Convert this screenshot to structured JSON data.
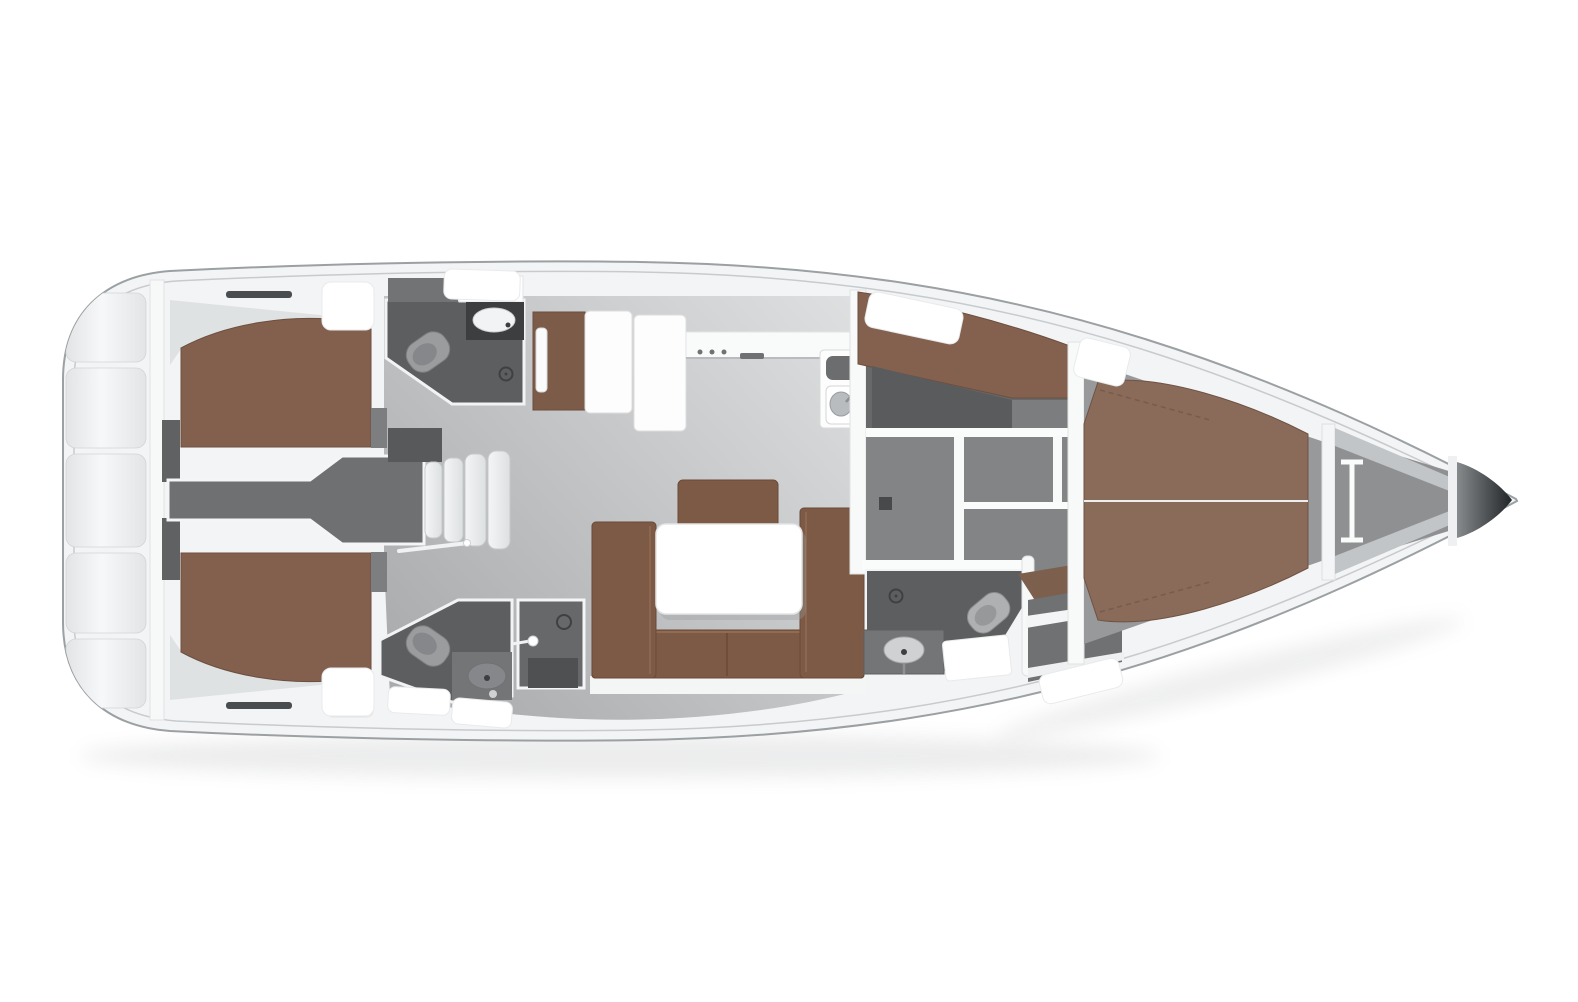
{
  "colors": {
    "background": "#ffffff",
    "hull_fill": "#f3f4f5",
    "hull_outline": "#9ba0a3",
    "inner_gunwale": "#c7cbcd",
    "platform_light": "#f7f8f9",
    "platform_dark": "#e2e4e6",
    "platform_seam": "#d2d5d7",
    "transom_wall": "#f7f8f8",
    "vent_slat": "#4a4d4f",
    "dark_strip": "#5f6163",
    "corner_shade": "#ccd0d2",
    "berth_aft": "#83604d",
    "berth_edge": "#6d4f3f",
    "berth_side": "#84614e",
    "berth_fwd": "#8a6a58",
    "berth_wedge": "#7d5f4e",
    "berth_seam": "#eceded",
    "quilt_line": "#6d5142",
    "cabin_locker": "#fefefe",
    "locker_stroke": "#e1e3e5",
    "head_floor": "#5c5e5f",
    "head_shelf": "#717375",
    "head_counter": "#3c3e3f",
    "shower_stall": "#66686a",
    "shower_tray": "#4e5052",
    "fixture_light": "#9a9c9e",
    "fixture_inner": "#85878a",
    "fixture_mid": "#737577",
    "toilet_fwd": "#aeb0b2",
    "sink_white": "#f2f3f4",
    "sink_gray": "#cfd1d3",
    "sink_basin": "#b9bcbe",
    "drain_ring": "#3e4041",
    "door_wood": "#7c5b49",
    "galley_unit": "#fdfdfd",
    "galley_stroke": "#dcdee0",
    "counter_white": "#f9fafa",
    "counter_edge": "#b9bcbe",
    "handle_dark": "#6f7173",
    "sink_tray": "#6b6d6f",
    "faucet": "#8e9193",
    "passage_floor": "#6e7072",
    "step_light": "#f4f5f6",
    "step_dark": "#dde0e1",
    "step_stroke": "#c6c9cb",
    "top_locker": "#57595b",
    "floor_light": "#dedfe0",
    "floor_dark": "#a9abad",
    "sofa": "#7d5a45",
    "sofa_edge": "#6a4a36",
    "sofa_highlight": "#916b52",
    "sofa_base": "#f4f5f5",
    "table": "#ffffff",
    "table_stroke": "#e3e5e6",
    "table_shadow": "#9b9ea0",
    "wall": "#f8f9f9",
    "wall_stroke": "#e0e2e4",
    "wall_bright": "#fafbfb",
    "door_handle": "#47494b",
    "sidecabin_floor": "#66686a",
    "wardrobe": "#595b5d",
    "sidecabin_step": "#7b7d7f",
    "corridor_floor": "#828486",
    "bench_gray": "#6f7173",
    "bench_strip": "#f4f5f6",
    "owner_floor": "#97999b",
    "anchor_floor": "#8e9092",
    "anchor_rib": "#c2c5c7",
    "rib_white": "#eef0f1",
    "windlass": "#fafbfb",
    "bow_dark_start": "#8b8e90",
    "bow_dark_end": "#222527",
    "deck_hatch": "#ffffff",
    "hatch_stroke": "#e8eaec",
    "shadow": "#8d9194",
    "door_rod": "#f1f2f3"
  }
}
